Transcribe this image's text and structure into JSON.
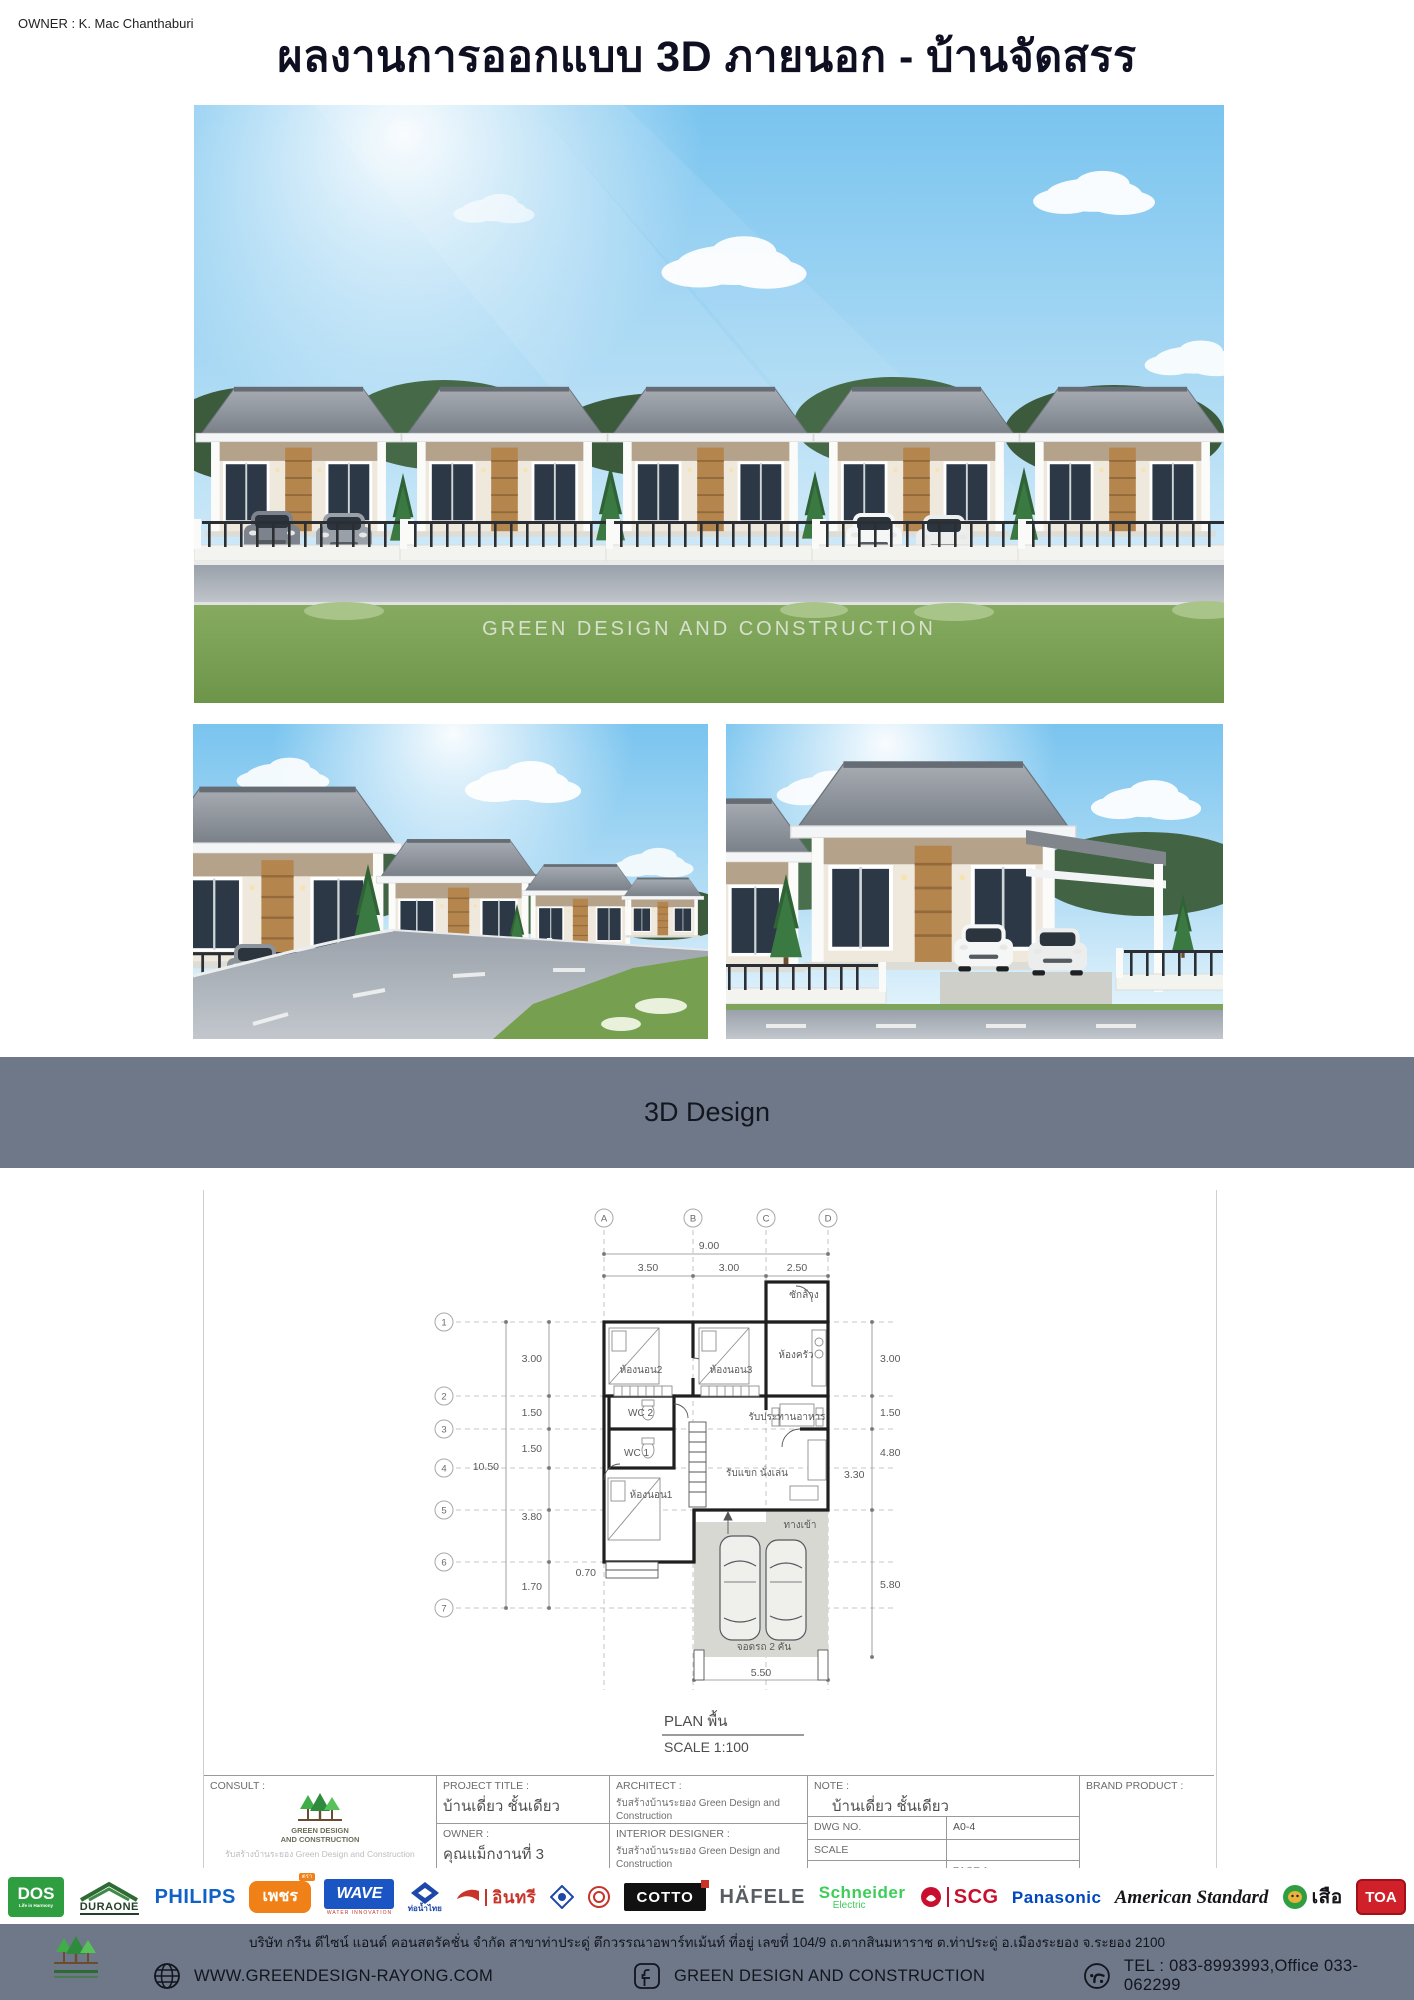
{
  "owner": "OWNER : K. Mac Chanthaburi",
  "title": "ผลงานการออกแบบ 3D ภายนอก - บ้านจัดสรร",
  "watermark": "GREEN DESIGN AND CONSTRUCTION",
  "banner": {
    "label": "3D Design",
    "bg": "#6e7888"
  },
  "plan": {
    "caption": "PLAN พื้น",
    "scale_caption": "SCALE  1:100",
    "grid_cols": [
      "A",
      "B",
      "C",
      "D"
    ],
    "grid_rows": [
      "1",
      "2",
      "3",
      "4",
      "5",
      "6",
      "7"
    ],
    "dim_total_width": "9.00",
    "dims_top": [
      "3.50",
      "3.00",
      "2.50"
    ],
    "dim_total_height": "10.50",
    "dims_left": [
      "3.00",
      "1.50",
      "1.50",
      "3.80",
      "0.70",
      "1.70"
    ],
    "dims_right": [
      "3.00",
      "1.50",
      "4.80",
      "3.30",
      "5.80"
    ],
    "dim_bottom": "5.50",
    "rooms": {
      "laundry": "ซักล้าง",
      "bedroom2": "ห้องนอน2",
      "bedroom3": "ห้องนอน3",
      "kitchen": "ห้องครัว",
      "wc2": "WC 2",
      "wc1": "WC 1",
      "dining": "รับประทานอาหาร",
      "bedroom1": "ห้องนอน1",
      "living": "รับแขก นั่งเล่น",
      "entrance": "ทางเข้า",
      "carport": "จอดรถ 2 คัน"
    }
  },
  "title_block": {
    "consult_label": "CONSULT :",
    "logo_line1": "GREEN DESIGN",
    "logo_line2": "AND CONSTRUCTION",
    "logo_sub": "รับสร้างบ้านระยอง Green Design and Construction",
    "project_title_label": "PROJECT TITLE :",
    "project_title": "บ้านเดี่ยว ชั้นเดียว",
    "owner_label": "OWNER :",
    "owner": "คุณแม็กงานที่ 3",
    "architect_label": "ARCHITECT :",
    "architect": "รับสร้างบ้านระยอง Green Design and Construction",
    "interior_label": "INTERIOR DESIGNER :",
    "interior": "รับสร้างบ้านระยอง Green Design and Construction",
    "note_label": "NOTE :",
    "note": "บ้านเดี่ยว ชั้นเดียว",
    "dwg_label": "DWG NO.",
    "dwg_no": "A0-4",
    "scale_label": "SCALE",
    "page_partial": "PAGE 1",
    "brand_label": "BRAND PRODUCT :"
  },
  "logos": [
    {
      "name": "dos",
      "text": "DOS",
      "sub": "Life in Harmony"
    },
    {
      "name": "dura-one",
      "text": "DURAONE"
    },
    {
      "name": "philips",
      "text": "PHILIPS"
    },
    {
      "name": "petch",
      "text": "เพชร",
      "sub": "ตรา"
    },
    {
      "name": "wave",
      "text": "WAVE",
      "sub": "WATER INNOVATION"
    },
    {
      "name": "thai-pipe",
      "text": "ท่อน้ำไทย"
    },
    {
      "name": "insee",
      "text": "อินทรี"
    },
    {
      "name": "cotto",
      "text": "COTTO"
    },
    {
      "name": "hafele",
      "text": "HÄFELE"
    },
    {
      "name": "schneider",
      "text": "Schneider",
      "sub": "Electric"
    },
    {
      "name": "scg",
      "text": "SCG"
    },
    {
      "name": "panasonic",
      "text": "Panasonic"
    },
    {
      "name": "american-standard",
      "text": "American Standard"
    },
    {
      "name": "suea",
      "text": "เสือ"
    },
    {
      "name": "toa",
      "text": "TOA"
    }
  ],
  "footer": {
    "address": "บริษัท กรีน ดีไซน์ แอนด์ คอนสตรัคชั่น จำกัด สาขาท่าประดู่ ตึกวรรณาอพาร์ทเม้นท์ ที่อยู่ เลขที่ 104/9  ถ.ตากสินมหาราช  ต.ท่าประดู่ อ.เมืองระยอง  จ.ระยอง 2100",
    "website": "WWW.GREENDESIGN-RAYONG.COM",
    "facebook": "GREEN DESIGN AND CONSTRUCTION",
    "tel": "TEL : 083-8993993,Office 033-062299"
  }
}
